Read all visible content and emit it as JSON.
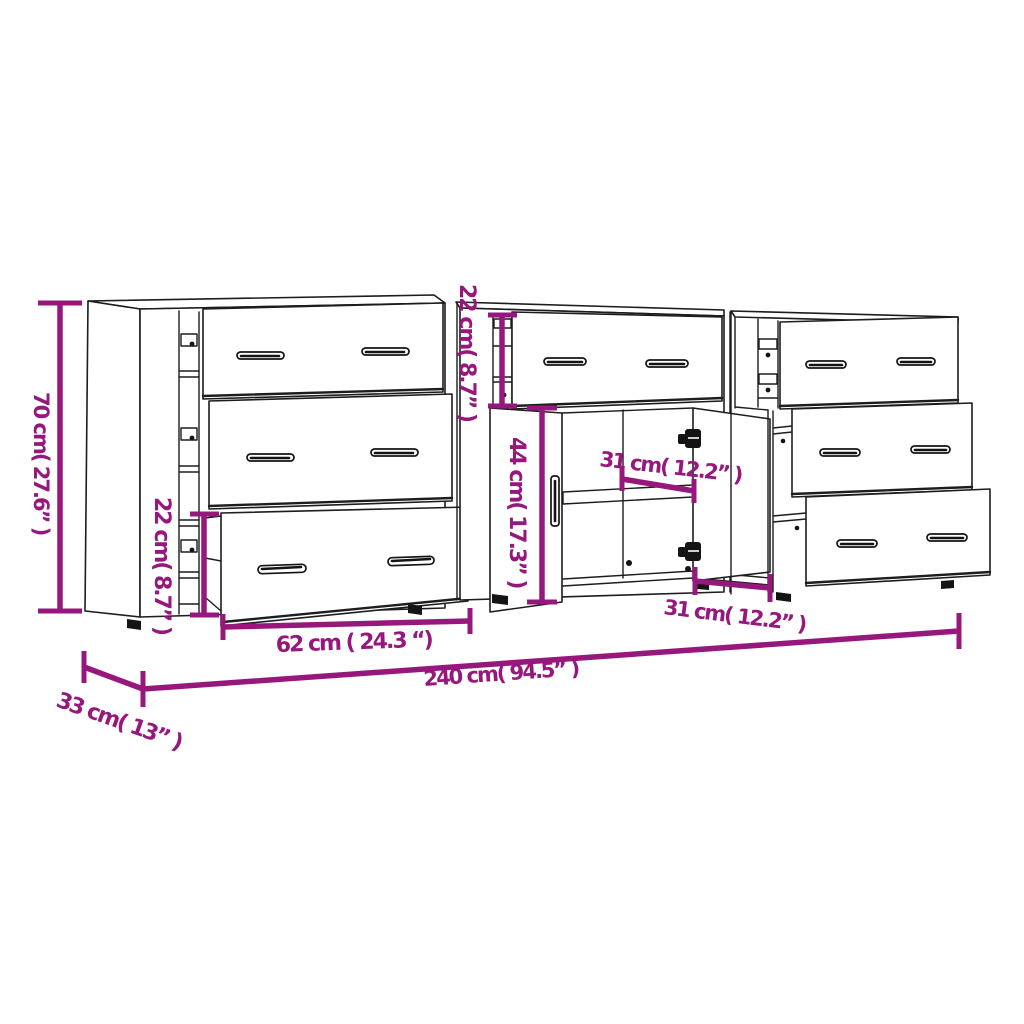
{
  "title": "Sideboard set dimension diagram",
  "colors": {
    "accent": "#97187D",
    "line": "#1D1D1D",
    "background": "#FFFFFF"
  },
  "diagram": {
    "product": "Three sideboard cabinets side by side (line drawing)",
    "units": [
      "cm",
      "inch"
    ],
    "dimensions": {
      "overall_height": {
        "cm": 70,
        "inch": 27.6,
        "label": "70 cm( 27.6” )"
      },
      "overall_width": {
        "cm": 240,
        "inch": 94.5,
        "label": "240 cm( 94.5” )"
      },
      "overall_depth": {
        "cm": 33,
        "inch": 13,
        "label": "33 cm( 13” )"
      },
      "drawer_front_width": {
        "cm": 62,
        "inch": 24.3,
        "label": "62 cm ( 24.3 “)"
      },
      "left_drawer_height": {
        "cm": 22,
        "inch": 8.7,
        "label": "22 cm( 8.7” )"
      },
      "middle_drawer_height": {
        "cm": 22,
        "inch": 8.7,
        "label": "22 cm( 8.7” )"
      },
      "door_height": {
        "cm": 44,
        "inch": 17.3,
        "label": "44 cm( 17.3” )"
      },
      "shelf_depth": {
        "cm": 31,
        "inch": 12.2,
        "label": "31 cm( 12.2” )"
      },
      "compartment_depth": {
        "cm": 31,
        "inch": 12.2,
        "label": "31 cm( 12.2” )"
      }
    }
  }
}
